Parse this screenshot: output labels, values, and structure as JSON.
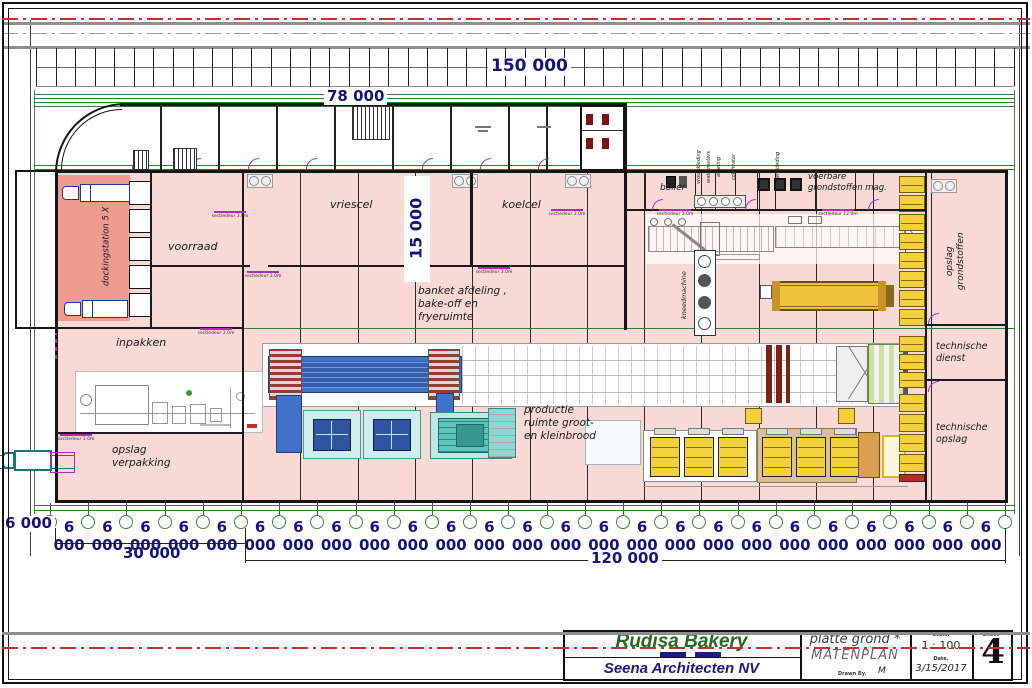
{
  "sheet": {
    "dimensions": {
      "total_width": "150 000",
      "left_wing_width": "78 000",
      "hall_depth": "15 000",
      "span_left": "30 000",
      "span_right": "120 000",
      "bay_width": "6 000",
      "left_edge_bay": "6 000"
    },
    "rooms": {
      "dockingstation": "dockingstation 5 X",
      "voorraad": "voorraad",
      "vriescel": "vriescel",
      "koelcel": "koelcel",
      "banket_line1": "banket afdeling ,",
      "banket_line2": "bake-off en",
      "banket_line3": "fryeruimte",
      "inpakken": "inpakken",
      "opslag_verpakking_line1": "opslag",
      "opslag_verpakking_line2": "verpakking",
      "productie_line1": "productie",
      "productie_line2": "ruimte groot-",
      "productie_line3": "en kleinbrood",
      "boiler": "boiler",
      "voerbare_line1": "voerbare",
      "voerbare_line2": "grondstoffen mag.",
      "kneedmachine": "kneedmachine",
      "opslag_grondstoffen_line1": "opslag",
      "opslag_grondstoffen_line2": "grondstoffen",
      "technische_dienst_line1": "technische",
      "technische_dienst_line2": "dienst",
      "technische_opslag_line1": "technische",
      "technische_opslag_line2": "opslag",
      "kleedruimte_labels": [
        "vrouwkleding",
        "watermeters",
        "afdeling",
        "cold/water",
        "werkkleding"
      ]
    },
    "annotations": [
      {
        "text": "sectiedeur 3.0m",
        "x": 230,
        "y": 216
      },
      {
        "text": "sectiedeur 3.0m",
        "x": 263,
        "y": 276
      },
      {
        "text": "sectiedeur 3.0m",
        "x": 216,
        "y": 333
      },
      {
        "text": "sectiedeur 3.0m",
        "x": 494,
        "y": 272
      },
      {
        "text": "sectiedeur 3.0m",
        "x": 567,
        "y": 214
      },
      {
        "text": "sectiedeur 3.0m",
        "x": 675,
        "y": 214
      },
      {
        "text": "sectiedeur 12.0m",
        "x": 838,
        "y": 214
      },
      {
        "text": "sectiedeur 3.0m",
        "x": 76,
        "y": 439
      }
    ],
    "title_block": {
      "client": "Rudisa Bakery",
      "architect": "Seena Architecten NV",
      "drawing_title_line1": "platte grond *",
      "drawing_title_line2": "MATENPLAN",
      "drawn_by_label": "Drawn By.",
      "drawn_by": "M",
      "scale_label": "Scale.",
      "scale_value": "1 : 100",
      "date_label": "Date.",
      "date_value": "3/15/2017",
      "sheet_label": "Sheet *",
      "sheet_number": "4"
    },
    "colors": {
      "hall_fill": "#f8d9d6",
      "dock_fill": "#ee9c92",
      "grid_green": "#3a8a3a",
      "dimension_navy": "#14147d",
      "door_magenta": "#b428b4",
      "equipment_yellow": "#f2d13a",
      "equipment_tan": "#d9c193",
      "conveyor_blue": "#3f72c8",
      "machine_teal": "#5cc5bd",
      "panel_cyan": "#cdeeec",
      "centerline_red": "#c23030",
      "title_green": "#1e6e1e",
      "title_navy": "#1a1a8e"
    }
  }
}
